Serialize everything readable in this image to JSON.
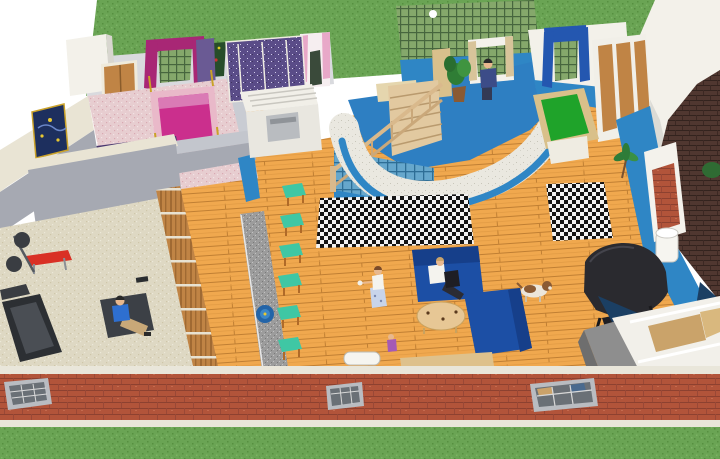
{
  "meta": {
    "title": "3D rendered home floor plan, isometric cutaway view",
    "people_visible": 5,
    "pets_visible": 1
  },
  "rooms": [
    {
      "name": "master-bedroom",
      "items": [
        "four-poster magenta bed",
        "window with magenta curtains",
        "wall tapestry",
        "wooden double doors",
        "white corner closet",
        "purple runner rug"
      ]
    },
    {
      "name": "hallway",
      "items": [
        "starry-night painting"
      ]
    },
    {
      "name": "home-gym",
      "items": [
        "treadmill",
        "red weight bench",
        "barbell plates",
        "exercise mat",
        "sitting man in blue shirt",
        "small dumbbell"
      ]
    },
    {
      "name": "kids-bedroom",
      "items": [
        "purple patterned bed",
        "window with pink curtains",
        "white closet with slatted top",
        "gray appliance"
      ]
    },
    {
      "name": "stairwell",
      "items": [
        "wooden staircase",
        "wooden handrail",
        "glass-block lower wall"
      ]
    },
    {
      "name": "office-nook",
      "items": [
        "curved white wall with blue stripe",
        "green lattice wall",
        "desk",
        "tall shelf",
        "potted plant",
        "standing man in dark suit",
        "curtained window"
      ]
    },
    {
      "name": "games-room",
      "items": [
        "pool table with green felt",
        "window with blue curtains",
        "wooden closet doors"
      ]
    },
    {
      "name": "great-room",
      "items": [
        "granite counter with blue sink",
        "six teal bar stools",
        "wood slat divider",
        "two houndstooth rugs",
        "two blue sofas",
        "man on sofa with laptop",
        "standing woman with tray",
        "toddler",
        "beagle dog",
        "oval coffee table",
        "black grand piano",
        "brick fireplace with white mantel",
        "white pillar",
        "palm plant",
        "white wall heater",
        "tan bench"
      ]
    },
    {
      "name": "entry",
      "items": [
        "white door frame seen from above",
        "tan door panels",
        "gray roof wedge",
        "navy floor wedges"
      ]
    }
  ],
  "exterior": {
    "front_wall": "red brick with three lattice windows and cream trim",
    "lawn": "green grass band at top and bottom",
    "right_structure": "white upper wall with dark brick chimney and green shrub"
  },
  "colors": {
    "bg": "#ffffff",
    "grass": "#6aa454",
    "brick": "#b2543a",
    "brick_dark_tower": "#503730",
    "wood": "#f0a84e",
    "wall_gray": "#a6a9b2",
    "wall_gray_light": "#c3c6cd",
    "wall_light": "#d9dade",
    "wall_cream": "#e9e4d4",
    "wall_white": "#f3f1ea",
    "wall_blue": "#2f86c5",
    "office_floor": "#2e7fc2",
    "lattice_green": "#85a86b",
    "lattice_blue": "#66a7cc",
    "curved_wall": "#eae8e0",
    "pink_floor": "#e7cdd0",
    "pink_bed_frame": "#e9b9c9",
    "magenta": "#cb2f8d",
    "magenta_dark": "#a82775",
    "purple_bed": "#5a4c88",
    "purple_rug": "#4a3870",
    "beige_carpet": "#ded8c3",
    "counter": "#9c9c9c",
    "sink": "#2264a8",
    "stool": "#3fc7a4",
    "stool_leg": "#b06a28",
    "sofa": "#1c4fa5",
    "sofa_dark": "#163f8a",
    "table_tan": "#e7c795",
    "piano": "#2a2a2f",
    "felt": "#1fa32a",
    "pool_frame": "#d9c08a",
    "door_wood": "#c08445",
    "red_bench": "#d93025",
    "treadmill": "#2c2f33",
    "mat": "#3c4046",
    "skin": "#e8b88e",
    "shirt_white": "#f4f3ee",
    "shirt_blue": "#2e6fd0",
    "khaki": "#c8a878",
    "suit_blue": "#3c4c88",
    "skirt": "#c8d4ea",
    "toddler": "#a55ab5",
    "dog_white": "#ece6da",
    "dog_brown": "#8a5a33",
    "navy": "#1b3f63",
    "roof_gray": "#8e8e8e",
    "plant": "#2f7d35",
    "heater_white": "#f6f5f0",
    "trim_cream": "#e9e6da",
    "window_frame": "#b9bcc1",
    "window_glass": "#6a7076",
    "curtain_blue": "#2457b0",
    "curtain_pink": "#e8a8c8",
    "tapestry": "#274d2a",
    "painting_navy": "#1d2f5e",
    "gold": "#c9a227"
  }
}
